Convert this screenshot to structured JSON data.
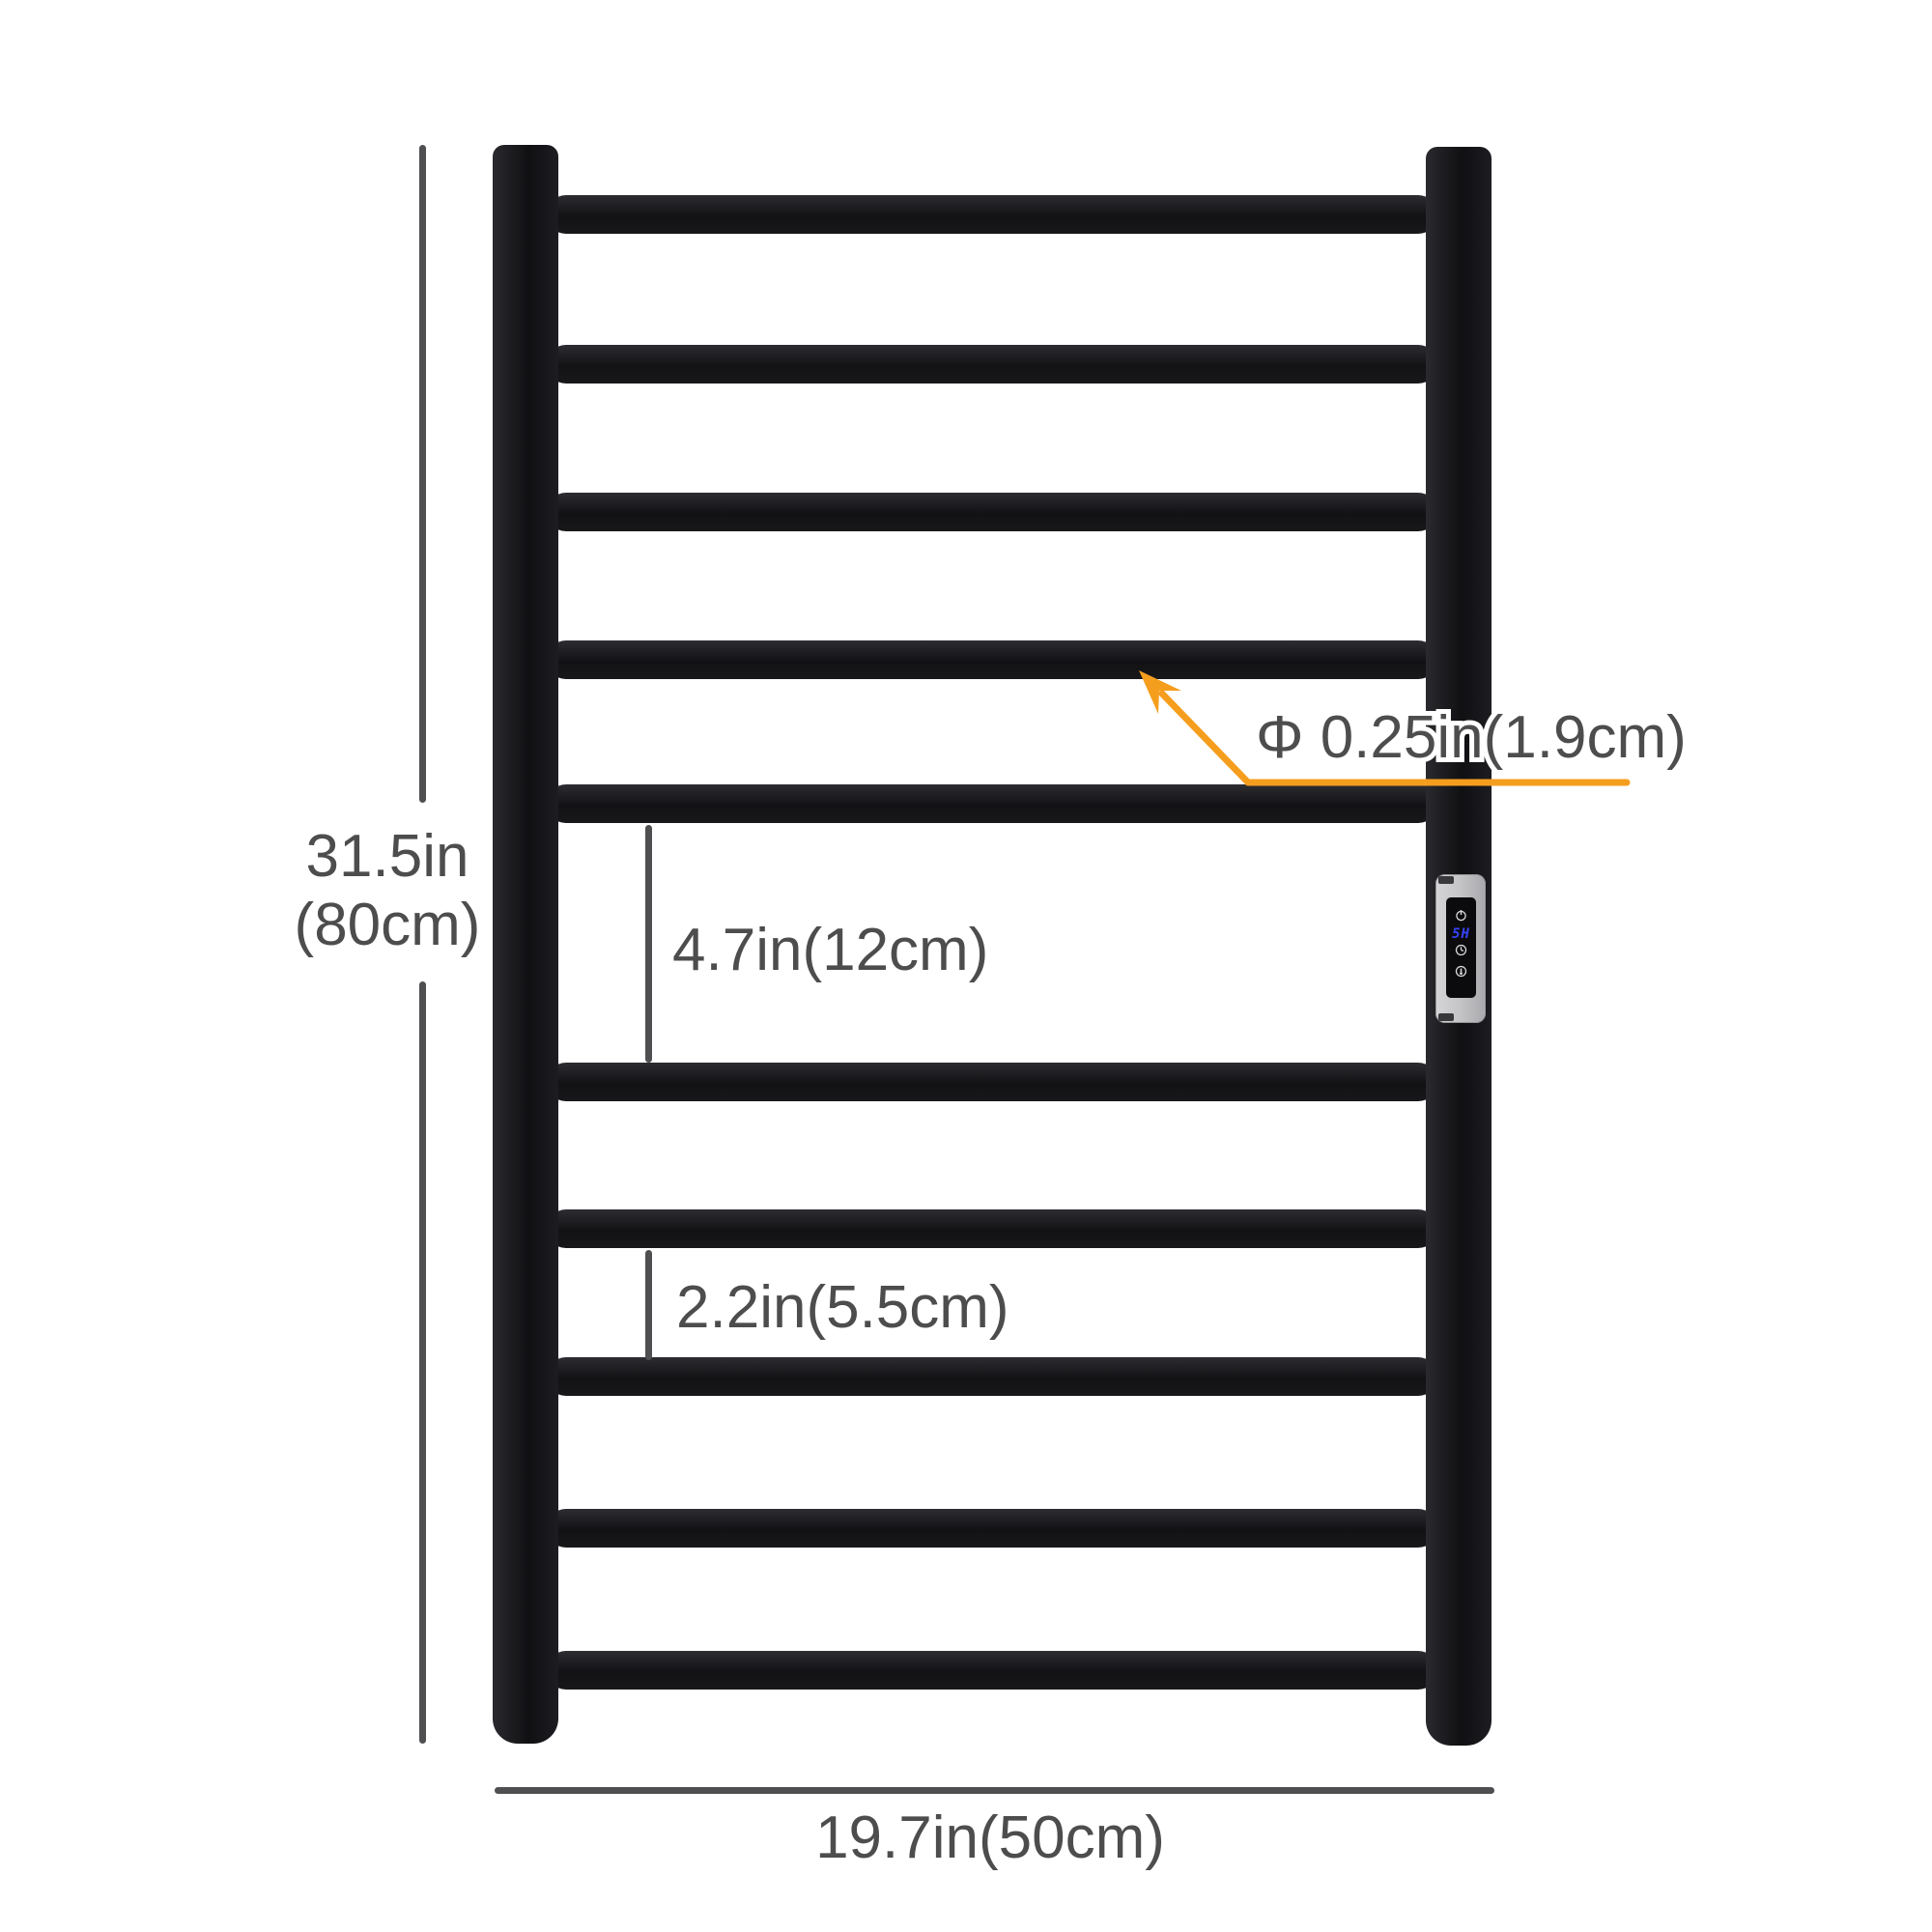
{
  "diagram": {
    "type": "product-dimension-diagram",
    "subject": "wall-mounted heated towel rail, 10 round bars, side control panel",
    "bar_count": 10,
    "labels": {
      "height_in": "31.5in",
      "height_cm": "(80cm)",
      "width": "19.7in(50cm)",
      "bar_diameter": "Φ 0.25in(1.9cm)",
      "wide_gap": "4.7in(12cm)",
      "narrow_gap": "2.2in(5.5cm)"
    },
    "control_panel": {
      "display_value": "5H",
      "icons": [
        "power-icon",
        "clock-icon",
        "heat-icon"
      ]
    },
    "colors": {
      "rack_black": "#17171a",
      "label_gray": "#4d4d4d",
      "dimension_line_gray": "#4f4f52",
      "accent_orange": "#F59E1E",
      "panel_silver": "#c6c6c9",
      "screen_black": "#0b0b0d",
      "led_blue": "#3743f5"
    }
  }
}
